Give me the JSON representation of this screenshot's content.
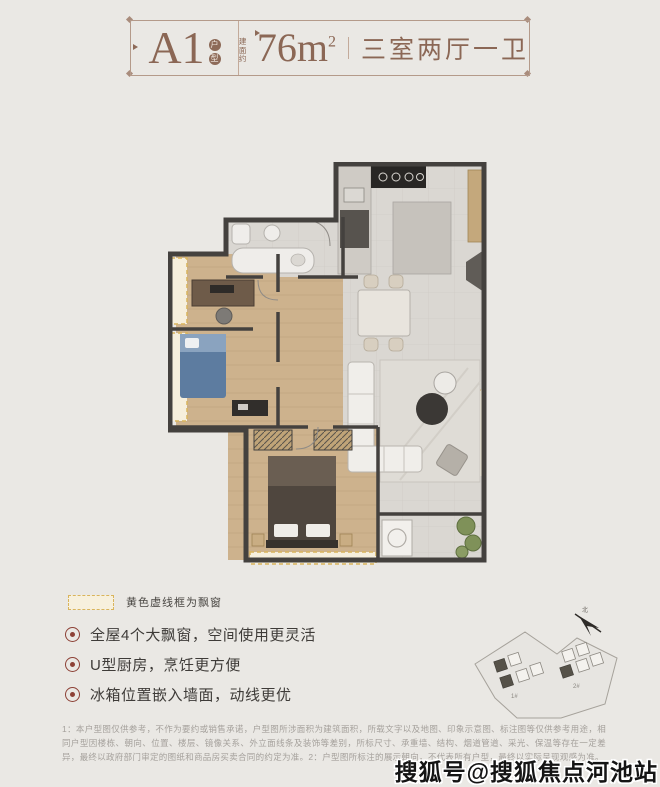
{
  "header": {
    "unit": "A1",
    "unit_badge_1": "户",
    "unit_badge_2": "型",
    "area_prefix": "建面约",
    "area_value": "76",
    "area_unit": "m",
    "area_sup": "2",
    "layout": "三室两厅一卫"
  },
  "legend": {
    "label": "黄色虚线框为飘窗"
  },
  "features": [
    {
      "text": "全屋4个大飘窗，空间使用更灵活"
    },
    {
      "text": "U型厨房，烹饪更方便"
    },
    {
      "text": "冰箱位置嵌入墙面，动线更优"
    }
  ],
  "sitemap": {
    "label_1": "1#",
    "label_2": "2#",
    "north_label": "北"
  },
  "disclaimer": "1：本户型图仅供参考，不作为要约或销售承诺，户型图所涉面积为建筑面积，所载文字以及地图、印象示意图、标注图等仅供参考用途，相同户型因楼栋、朝向、位置、楼层、镜像关系、外立面线条及装饰等差别，所标尺寸、承重墙、结构、烟道管道、采光、保温等存在一定差异，最终以政府部门审定的图纸和商品房买卖合同的约定为准。2：户型图所标注的展示朝向，不代表所有户型，最终以实际呈现观感为准。",
  "watermark": "搜狐号@搜狐焦点河池站",
  "colors": {
    "accent_brown": "#8b6755",
    "bullet_red": "#8d4136",
    "bay_yellow": "#d9b45c",
    "wall_dark": "#44413e",
    "wood": "#cdb28d",
    "tile": "#dad7d2",
    "plant_green": "#7f9159",
    "bed_blue": "#5d7ca0"
  }
}
